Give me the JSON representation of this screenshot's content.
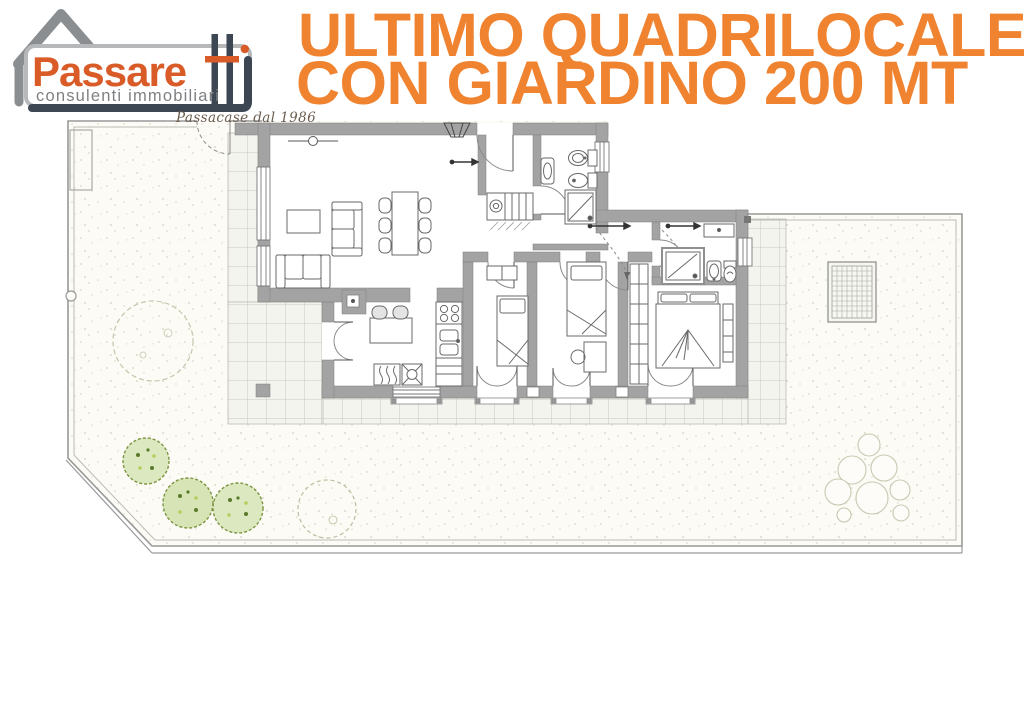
{
  "logo": {
    "brand_primary": "Passare",
    "brand_suffix": "tti",
    "tagline": "consulenti immobiliari",
    "slogan": "Passacase dal 1986"
  },
  "headline": {
    "line1": "ULTIMO QUADRILOCALE",
    "line2": "CON GIARDINO 200 MT"
  },
  "colors": {
    "headline_orange": "#f08330",
    "logo_orange": "#d95c28",
    "logo_slate": "#3d4653",
    "logo_gray_text": "#7e8184",
    "house_outline_gray": "#8b8e91",
    "wall_gray": "#a3a3a3",
    "tile_line_gray": "#c8c8c2",
    "garden_base": "#fcfbf5",
    "hedge_green": "#8aa04a",
    "outline_plant_green": "#c2c8ac"
  },
  "floor_plan": {
    "type": "apartment-with-garden",
    "rooms": [
      "living-room",
      "kitchen",
      "entry-hall",
      "bathroom-1",
      "bathroom-2",
      "bedroom-1",
      "bedroom-2",
      "master-bedroom"
    ],
    "outdoor_features": [
      "garden",
      "tiled-patio",
      "garden-gate",
      "hedge-bushes",
      "outline-trees",
      "drain-grate",
      "boundary-fence"
    ],
    "furniture": [
      "sofa",
      "chaise-sofa",
      "coffee-table",
      "dining-table",
      "dining-chairs",
      "kitchen-table",
      "kitchen-chairs",
      "stove",
      "kitchen-sink",
      "radiator",
      "washing-machine",
      "closet",
      "shower",
      "toilet",
      "bidet",
      "washbasin",
      "single-bed",
      "double-bed",
      "wardrobe",
      "desk",
      "dresser"
    ]
  }
}
